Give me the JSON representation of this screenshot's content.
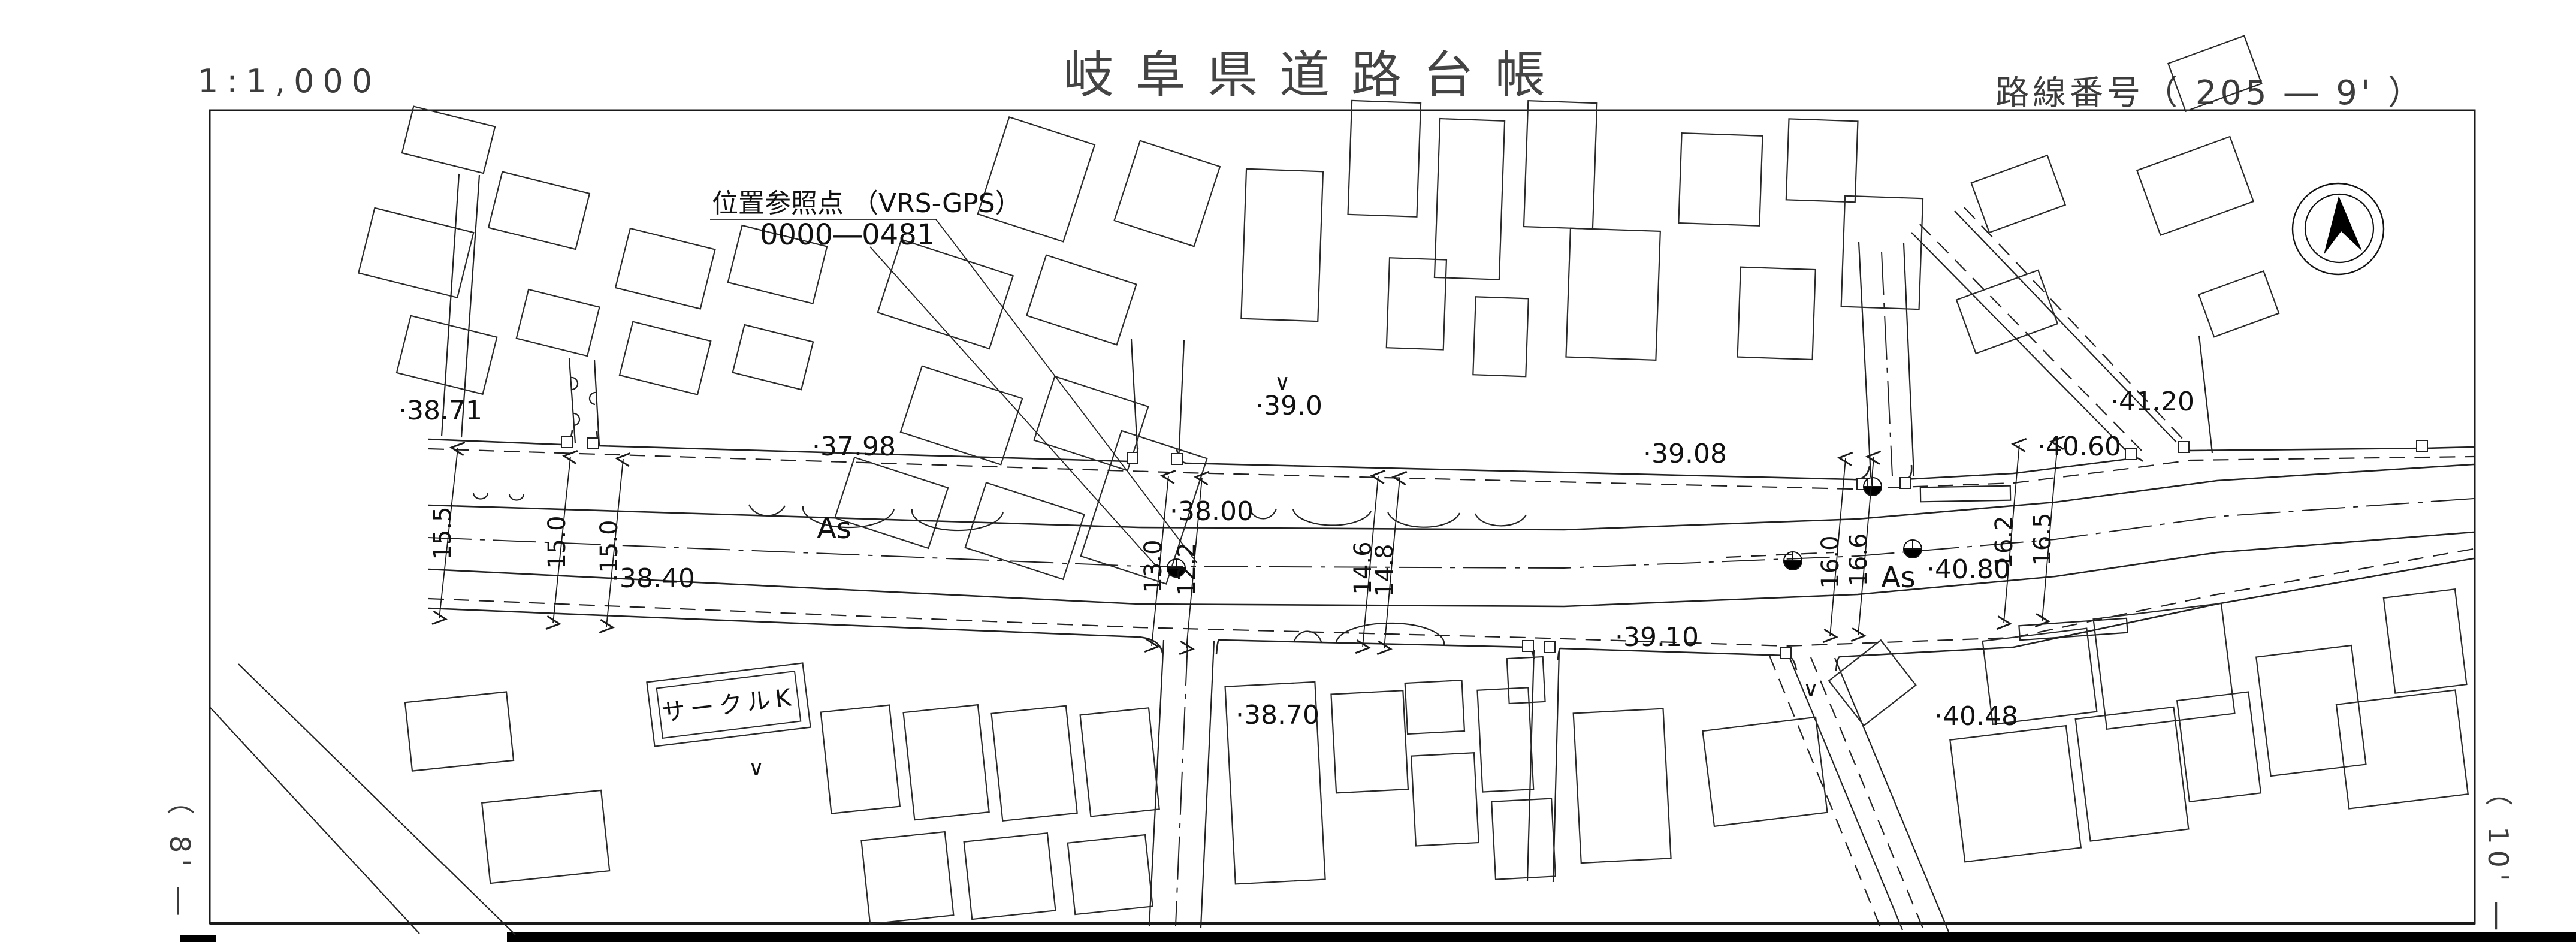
{
  "header": {
    "scale": "1:1,000",
    "title": "岐阜県道路台帳",
    "route_number": "路線番号（ 205 ― 9' ）"
  },
  "sheet_refs": {
    "left": "（ 8' ―",
    "right": "（ 10' ―"
  },
  "reference_point": {
    "label": "位置参照点 （VRS-GPS）",
    "number": "0000―0481"
  },
  "map": {
    "pavement_labels": [
      "As",
      "As"
    ],
    "building_labels": [
      "サークルK"
    ],
    "vegetation_mark": "∨",
    "spot_elevations": [
      "·38.71",
      "·37.98",
      "·39.0",
      "·39.08",
      "·38.00",
      "·38.40",
      "·40.80",
      "·39.10",
      "·38.70",
      "·40.48",
      "·40.60",
      "·41.20"
    ],
    "road_widths": [
      "15.5",
      "15.0",
      "15.0",
      "13.0",
      "12.2",
      "14.6",
      "14.8",
      "16.0",
      "16.6",
      "16.2",
      "16.5"
    ],
    "north_arrow": "north-arrow"
  },
  "colors": {
    "ink": "#1a1a1a",
    "paper": "#ffffff"
  }
}
